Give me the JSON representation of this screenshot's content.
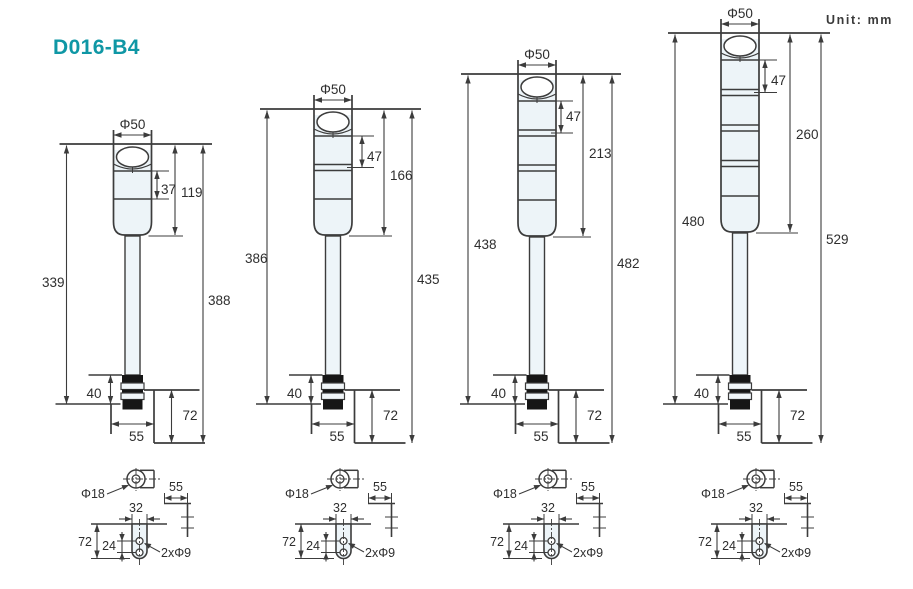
{
  "page": {
    "title": "D016-B4",
    "unit_label": "Unit: mm"
  },
  "colors": {
    "accent": "#0f97a5",
    "line": "#3c3c3c",
    "black": "#161616",
    "head_fill": "#edf4f8",
    "text": "#2e2e2e"
  },
  "towers": [
    {
      "phi": "Φ50",
      "tier_height": "37",
      "head_height": "119",
      "left_height": "339",
      "right_height": "388",
      "stem_height": "40",
      "base_width": "55",
      "bracket_height": "72"
    },
    {
      "phi": "Φ50",
      "tier_height": "47",
      "head_height": "166",
      "left_height": "386",
      "right_height": "435",
      "stem_height": "40",
      "base_width": "55",
      "bracket_height": "72"
    },
    {
      "phi": "Φ50",
      "tier_height": "47",
      "head_height": "213",
      "left_height": "438",
      "right_height": "482",
      "stem_height": "40",
      "base_width": "55",
      "bracket_height": "72"
    },
    {
      "phi": "Φ50",
      "tier_height": "47",
      "head_height": "260",
      "left_height": "480",
      "right_height": "529",
      "stem_height": "40",
      "base_width": "55",
      "bracket_height": "72"
    }
  ],
  "details": [
    {
      "pole_dia": "Φ18",
      "leg_width": "55",
      "plate_width": "32",
      "plate_height": "72",
      "hole_span": "24",
      "holes": "2xΦ9"
    },
    {
      "pole_dia": "Φ18",
      "leg_width": "55",
      "plate_width": "32",
      "plate_height": "72",
      "hole_span": "24",
      "holes": "2xΦ9"
    },
    {
      "pole_dia": "Φ18",
      "leg_width": "55",
      "plate_width": "32",
      "plate_height": "72",
      "hole_span": "24",
      "holes": "2xΦ9"
    },
    {
      "pole_dia": "Φ18",
      "leg_width": "55",
      "plate_width": "32",
      "plate_height": "72",
      "hole_span": "24",
      "holes": "2xΦ9"
    }
  ]
}
